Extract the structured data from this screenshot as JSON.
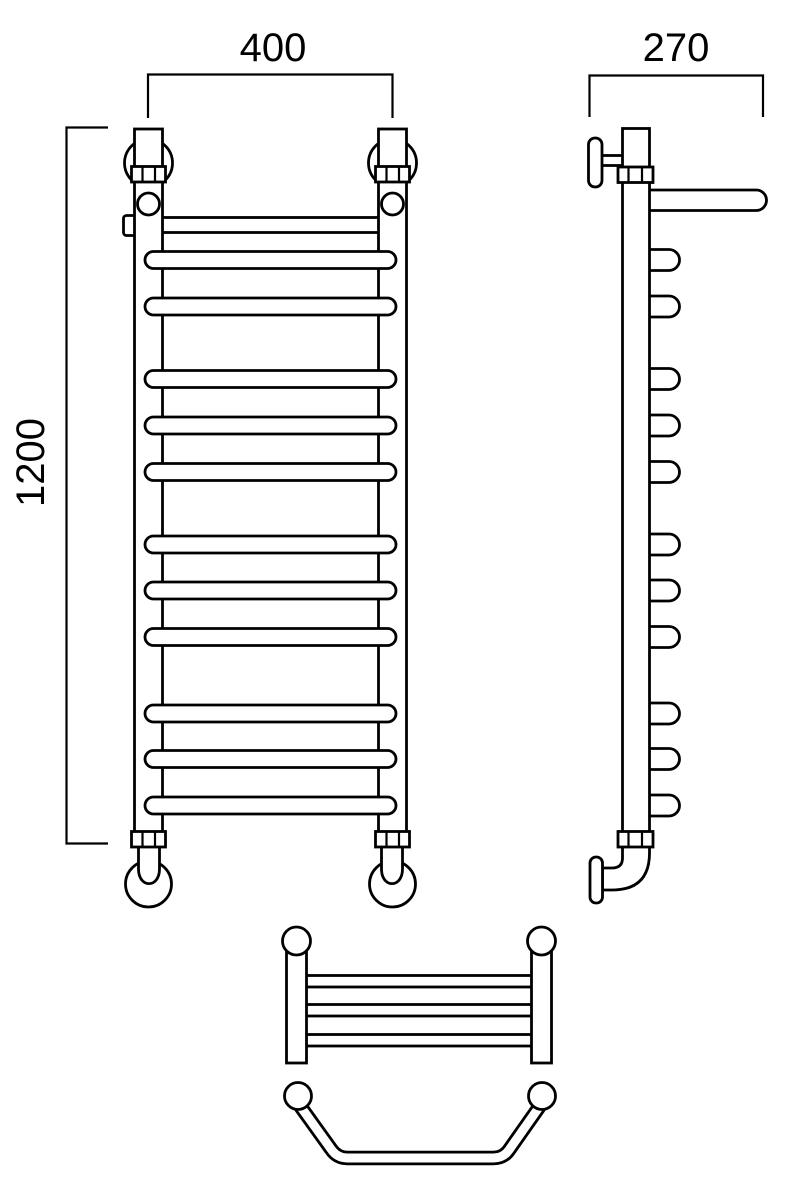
{
  "drawing": {
    "background_color": "#ffffff",
    "line_color": "#000000",
    "dimensions": {
      "width_mm": "400",
      "depth_mm": "270",
      "height_mm": "1200"
    },
    "front_view": {
      "rung_count": 11,
      "shelf_bar_count": 1
    },
    "side_view": {
      "rung_end_count": 11,
      "shelf_arm_count": 1
    },
    "top_view_shelf": {
      "bar_count": 3
    },
    "top_view_curved_rail": {
      "band_count": 1
    }
  }
}
